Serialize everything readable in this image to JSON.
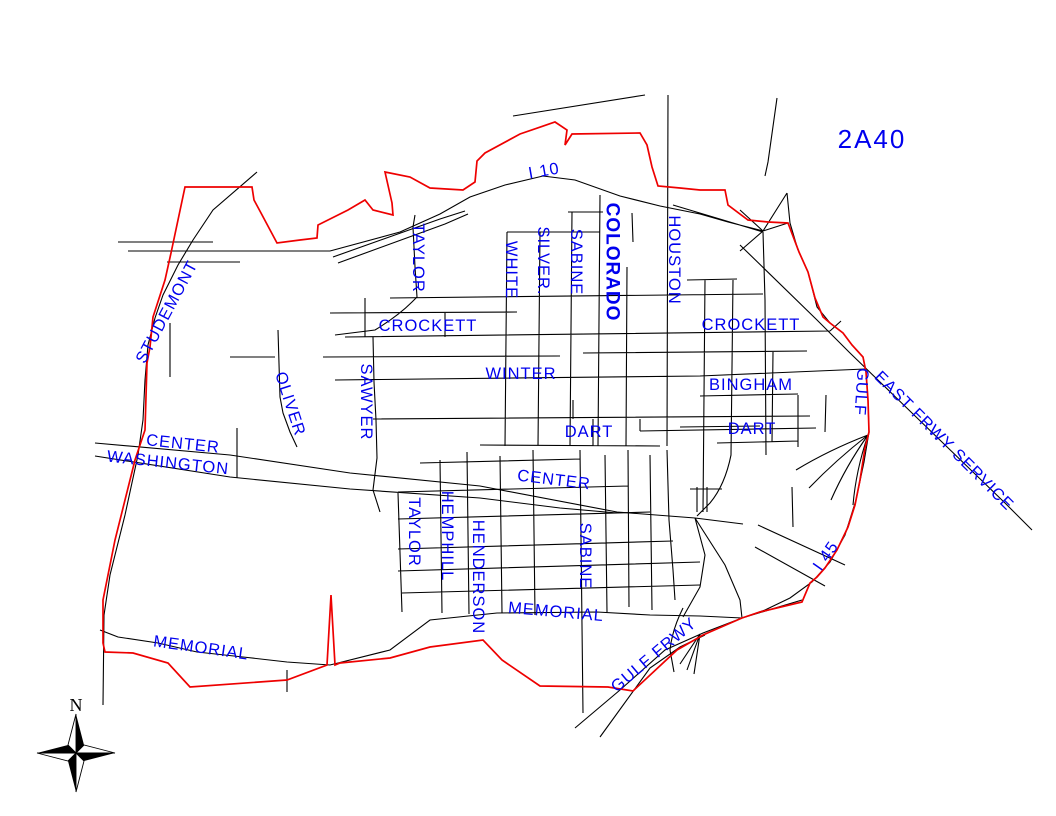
{
  "map": {
    "title": "2A40",
    "compass_north": "N",
    "colors": {
      "street": "#000000",
      "boundary": "#ee0000",
      "label_blue": "#0000ee"
    },
    "labels": [
      {
        "id": "i10",
        "text": "I 10"
      },
      {
        "id": "studemont",
        "text": "STUDEMONT"
      },
      {
        "id": "taylor-n",
        "text": "TAYLOR"
      },
      {
        "id": "white",
        "text": "WHITE"
      },
      {
        "id": "silver",
        "text": "SILVER."
      },
      {
        "id": "sabine-n",
        "text": "SABINE"
      },
      {
        "id": "colorado",
        "text": "COLORADO"
      },
      {
        "id": "houston",
        "text": "HOUSTON"
      },
      {
        "id": "crockett-w",
        "text": "CROCKETT"
      },
      {
        "id": "crockett-e",
        "text": "CROCKETT"
      },
      {
        "id": "sawyer",
        "text": "SAWYER"
      },
      {
        "id": "oliver",
        "text": "OLIVER"
      },
      {
        "id": "winter",
        "text": "WINTER"
      },
      {
        "id": "bingham",
        "text": "BINGHAM"
      },
      {
        "id": "dart-c",
        "text": "DART"
      },
      {
        "id": "dart-e",
        "text": "DART"
      },
      {
        "id": "center-w",
        "text": "CENTER"
      },
      {
        "id": "washington",
        "text": "WASHINGTON"
      },
      {
        "id": "center-c",
        "text": "CENTER"
      },
      {
        "id": "gulf",
        "text": "GULF"
      },
      {
        "id": "east-frwy",
        "text": "EAST FRWY SERVICE"
      },
      {
        "id": "taylor-s",
        "text": "TAYLOR"
      },
      {
        "id": "hemphill",
        "text": "HEMPHILL"
      },
      {
        "id": "henderson",
        "text": "HENDERSON"
      },
      {
        "id": "sabine-s",
        "text": "SABINE"
      },
      {
        "id": "memorial-c",
        "text": "MEMORIAL"
      },
      {
        "id": "memorial-w",
        "text": "MEMORIAL"
      },
      {
        "id": "gulf-frwy",
        "text": "GULF FRWY"
      },
      {
        "id": "i45",
        "text": "I 45"
      }
    ]
  }
}
